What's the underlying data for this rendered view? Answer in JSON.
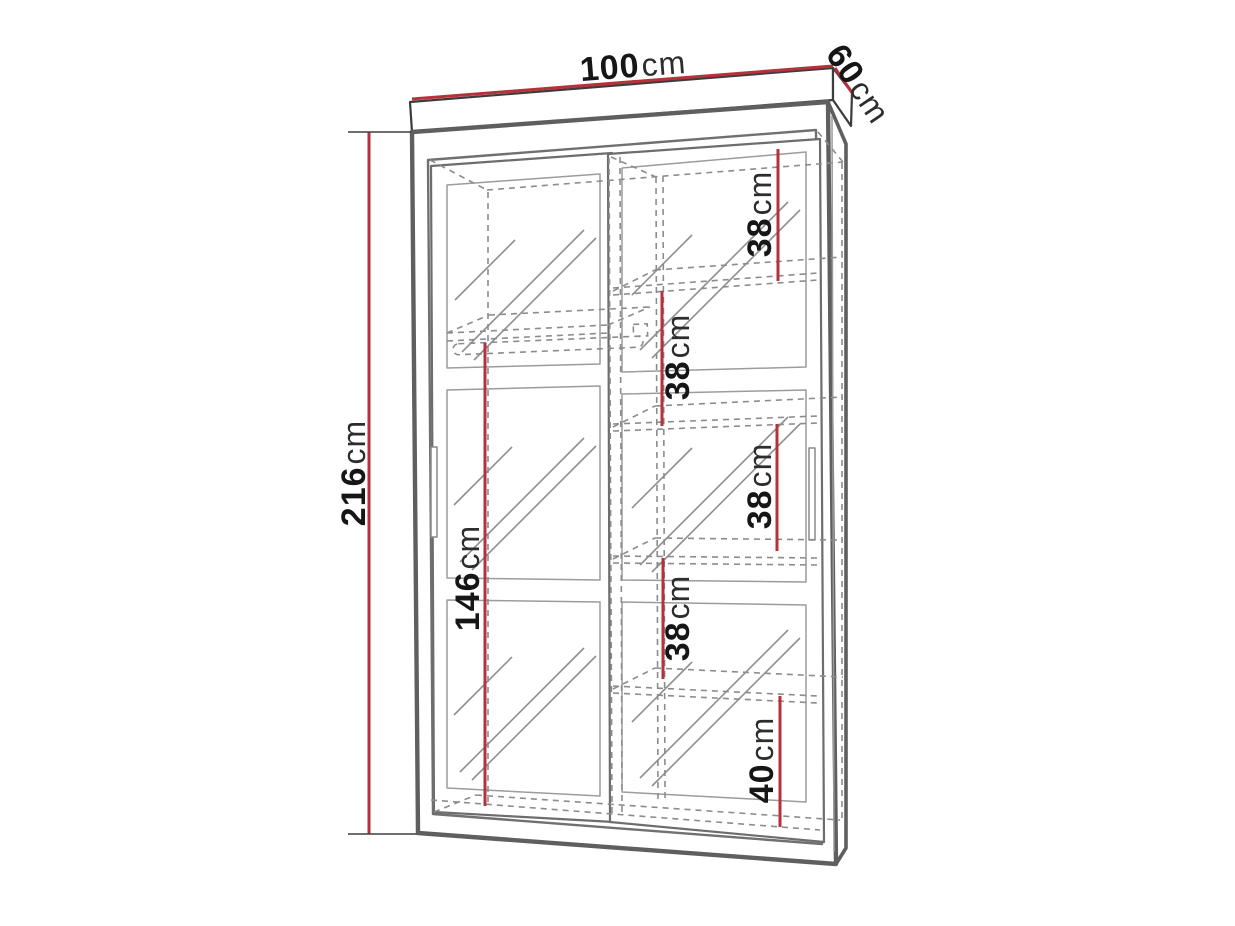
{
  "diagram": {
    "subject": "sliding-door mirrored wardrobe dimension drawing",
    "accent_color": "#b5323a",
    "outline_color": "#5f5f5f",
    "dashed_color": "#8c8c8c",
    "labels": {
      "width": {
        "value": "100",
        "unit": "cm"
      },
      "depth": {
        "value": "60",
        "unit": "cm"
      },
      "height": {
        "value": "216",
        "unit": "cm"
      },
      "interior_left_height": {
        "value": "146",
        "unit": "cm"
      },
      "shelf_top": {
        "value": "38",
        "unit": "cm"
      },
      "shelf_upper": {
        "value": "38",
        "unit": "cm"
      },
      "shelf_middle": {
        "value": "38",
        "unit": "cm"
      },
      "shelf_lower": {
        "value": "38",
        "unit": "cm"
      },
      "shelf_bottom": {
        "value": "40",
        "unit": "cm"
      }
    }
  }
}
